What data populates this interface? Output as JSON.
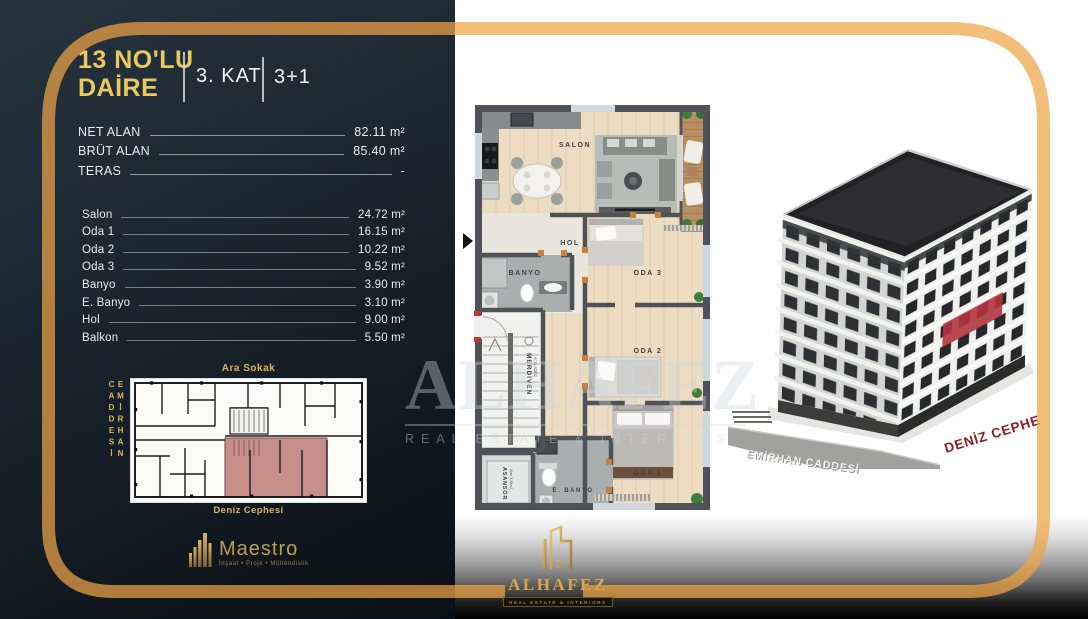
{
  "header": {
    "title_line1": "13 NO'LU",
    "title_line2": "DAİRE",
    "floor": "3. KAT",
    "plan_type": "3+1"
  },
  "areas": [
    {
      "label": "NET ALAN",
      "value": "82.11 m²"
    },
    {
      "label": "BRÜT ALAN",
      "value": "85.40 m²"
    },
    {
      "label": "TERAS",
      "value": "-"
    }
  ],
  "rooms": [
    {
      "label": "Salon",
      "value": "24.72 m²"
    },
    {
      "label": "Oda 1",
      "value": "16.15 m²"
    },
    {
      "label": "Oda 2",
      "value": "10.22 m²"
    },
    {
      "label": "Oda 3",
      "value": "9.52 m²"
    },
    {
      "label": "Banyo",
      "value": "3.90 m²"
    },
    {
      "label": "E. Banyo",
      "value": "3.10 m²"
    },
    {
      "label": "Hol",
      "value": "9.00 m²"
    },
    {
      "label": "Balkon",
      "value": "5.50 m²"
    }
  ],
  "site_plan": {
    "top_street": "Ara Sokak",
    "left_street": "EMİRHAN CADDESİ",
    "bottom_label": "Deniz Cephesi"
  },
  "floor_plan": {
    "salon": "SALON",
    "hol": "HOL",
    "banyo": "BANYO",
    "oda3": "ODA 3",
    "oda2": "ODA 2",
    "oda1": "ODA 1",
    "ebanyo": "E. BANYO",
    "merdiven": "MERDİVEN",
    "merdiven_area": "A:11.40m2",
    "asansor": "ASANSÖR",
    "asansor_area": "Alan 3.38m2"
  },
  "render": {
    "street_label": "EMİRHAN CADDESİ",
    "facade_label": "DENİZ CEPHESİ"
  },
  "watermark": {
    "brand": "ALHAFEZ",
    "tagline": "REAL ESTATE & INTERIORS"
  },
  "logos": {
    "maestro_name": "Maestro",
    "maestro_tagline": "İnşaat • Proje • Mühendislik",
    "alhafez_name": "ALHAFEZ",
    "alhafez_tagline": "REAL ESTATE & INTERIORS"
  },
  "colors": {
    "accent_gold": "#e9c35f",
    "border_gold": "#f0a94e",
    "highlight_red": "#b23440",
    "panel_dark": "#16202a"
  }
}
